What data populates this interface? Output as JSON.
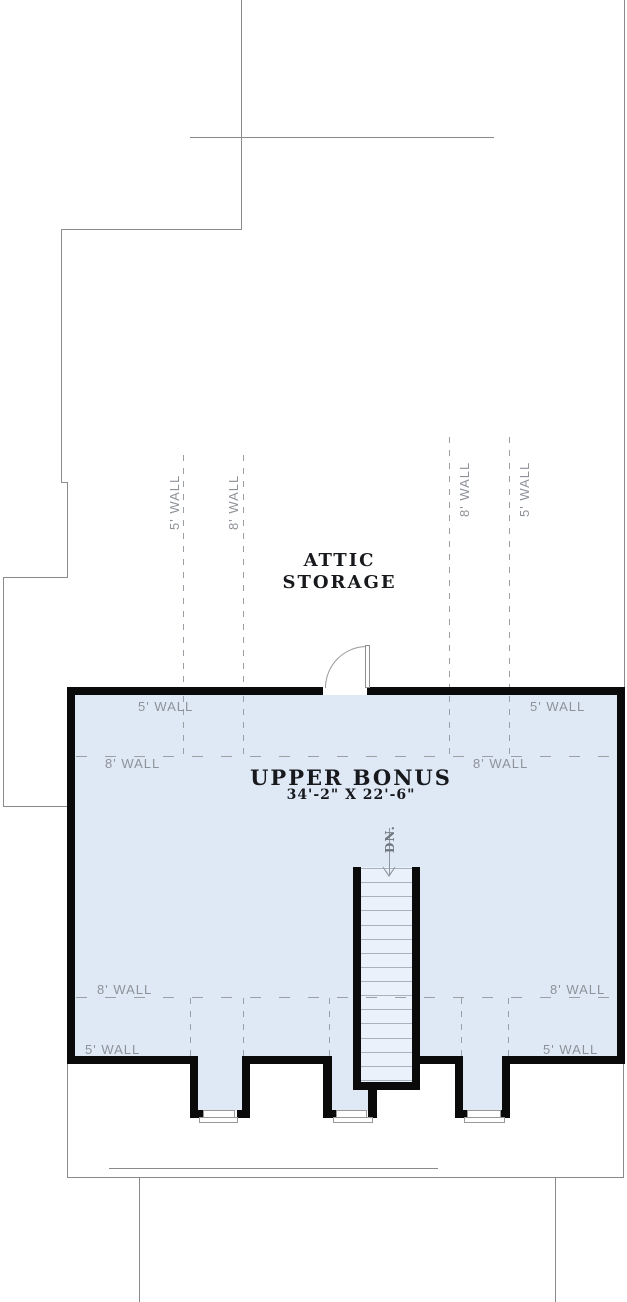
{
  "attic": {
    "line1": "ATTIC",
    "line2": "STORAGE"
  },
  "room": {
    "name": "UPPER BONUS",
    "dimensions": "34'-2\" X 22'-6\""
  },
  "stairs": {
    "label": "DN.",
    "tread_count": 16,
    "direction": "down"
  },
  "wall_labels": [
    {
      "text": "5' WALL",
      "placement": "attic-rotated-left-outer"
    },
    {
      "text": "8' WALL",
      "placement": "attic-rotated-left-inner"
    },
    {
      "text": "8' WALL",
      "placement": "attic-rotated-right-inner"
    },
    {
      "text": "5' WALL",
      "placement": "attic-rotated-right-outer"
    },
    {
      "text": "5' WALL",
      "placement": "room-top-left"
    },
    {
      "text": "5' WALL",
      "placement": "room-top-right"
    },
    {
      "text": "8' WALL",
      "placement": "room-mid-left"
    },
    {
      "text": "8' WALL",
      "placement": "room-mid-right"
    },
    {
      "text": "8' WALL",
      "placement": "room-bottom-left"
    },
    {
      "text": "8' WALL",
      "placement": "room-bottom-right"
    },
    {
      "text": "5' WALL",
      "placement": "room-lower-left"
    },
    {
      "text": "5' WALL",
      "placement": "room-lower-right"
    }
  ],
  "colors": {
    "wall": "#0a0a0a",
    "floor_fill": "#dfe9f6",
    "stair_fill": "#ebf1fa",
    "outline_gray": "#8a8a8a",
    "dash_gray": "#9aa0a6",
    "label_gray": "#8e9298",
    "text_dark": "#17191c"
  }
}
